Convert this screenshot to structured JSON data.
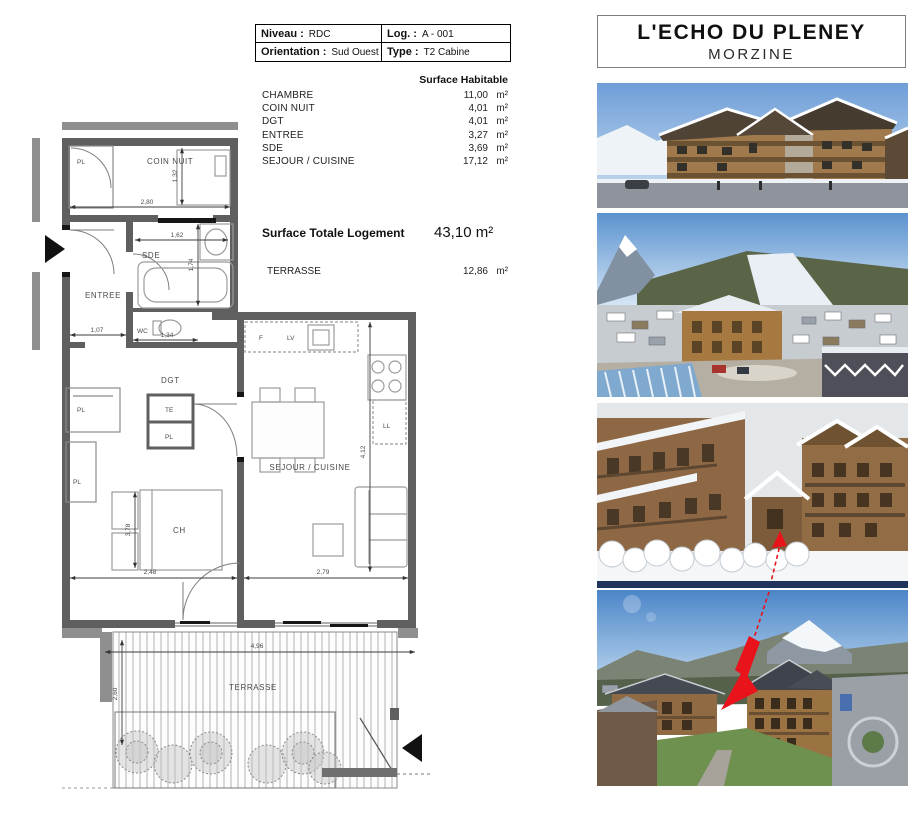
{
  "info_table": {
    "niveau_label": "Niveau :",
    "niveau_value": "RDC",
    "log_label": "Log. :",
    "log_value": "A - 001",
    "orientation_label": "Orientation :",
    "orientation_value": "Sud Ouest",
    "type_label": "Type :",
    "type_value": "T2 Cabine"
  },
  "surfaces": {
    "header": "Surface Habitable",
    "rows": [
      {
        "label": "CHAMBRE",
        "value": "11,00",
        "unit": "m²"
      },
      {
        "label": "COIN NUIT",
        "value": "4,01",
        "unit": "m²"
      },
      {
        "label": "DGT",
        "value": "4,01",
        "unit": "m²"
      },
      {
        "label": "ENTREE",
        "value": "3,27",
        "unit": "m²"
      },
      {
        "label": "SDE",
        "value": "3,69",
        "unit": "m²"
      },
      {
        "label": "SEJOUR / CUISINE",
        "value": "17,12",
        "unit": "m²"
      }
    ],
    "total_label": "Surface Totale Logement",
    "total_value": "43,10 m²",
    "terrasse_label": "TERRASSE",
    "terrasse_value": "12,86",
    "terrasse_unit": "m²"
  },
  "floorplan": {
    "labels": {
      "pl": "PL",
      "te": "TE",
      "coin_nuit": "COIN NUIT",
      "sde": "SDE",
      "entree": "ENTREE",
      "wc": "WC",
      "dgt": "DGT",
      "ch": "CH",
      "sejour_cuisine": "SEJOUR / CUISINE",
      "terrasse": "TERRASSE",
      "f": "F",
      "lv": "LV",
      "ll": "LL"
    },
    "dimensions": {
      "coin_nuit_width": "2,80",
      "coin_nuit_depth": "1,32",
      "sde_width": "1,62",
      "sde_depth": "1,74",
      "entree_width": "1,07",
      "wc_width": "1,34",
      "chambre_width": "2,48",
      "chambre_depth": "3,78",
      "sejour_width": "2,79",
      "sejour_depth": "4,12",
      "terrasse_width": "4,96",
      "terrasse_depth": "2,60"
    }
  },
  "listing": {
    "title": "L'ECHO DU PLENEY",
    "subtitle": "MORZINE",
    "accent_arrow_color": "#e8131b",
    "photos": [
      {
        "name": "photo-building-render"
      },
      {
        "name": "photo-village-aerial-winter"
      },
      {
        "name": "photo-residence-courtyard-winter"
      },
      {
        "name": "photo-village-aerial-summer"
      }
    ]
  }
}
